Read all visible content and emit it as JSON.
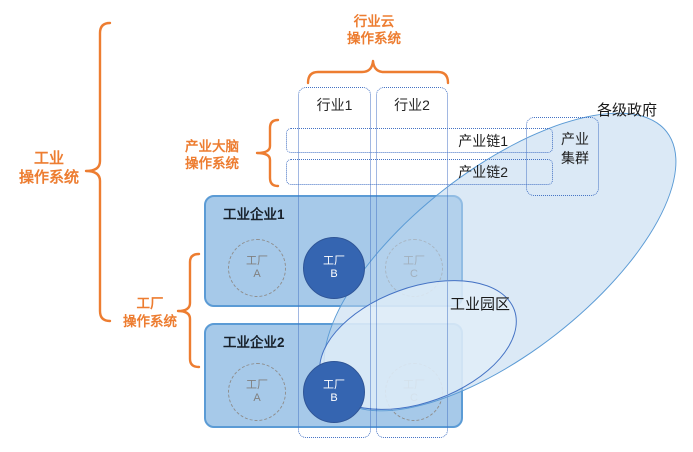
{
  "colors": {
    "accent_orange": "#ED7D31",
    "dashed_blue": "#4472C4",
    "enterprise_fill": "#A6C9E9",
    "enterprise_border": "#5B9BD5",
    "factory_filled_blue": "#3565B1",
    "factory_dashed_gray": "#808080",
    "ellipse_fill_blue": "#BDD7EE"
  },
  "labels": {
    "industry_os": [
      "工业",
      "操作系统"
    ],
    "industry_cloud_os": [
      "行业云",
      "操作系统"
    ],
    "industry_brain_os": [
      "产业大脑",
      "操作系统"
    ],
    "factory_os": [
      "工厂",
      "操作系统"
    ],
    "government": "各级政府",
    "industrial_park": "工业园区",
    "industry_cluster": [
      "产业",
      "集群"
    ]
  },
  "columns": [
    {
      "label": "行业1"
    },
    {
      "label": "行业2"
    }
  ],
  "chains": [
    {
      "label": "产业链1"
    },
    {
      "label": "产业链2"
    }
  ],
  "enterprises": [
    {
      "title": "工业企业1",
      "factories": [
        {
          "name": "工厂",
          "id": "A"
        },
        {
          "name": "工厂",
          "id": "B"
        },
        {
          "name": "工厂",
          "id": "C"
        }
      ]
    },
    {
      "title": "工业企业2",
      "factories": [
        {
          "name": "工厂",
          "id": "A"
        },
        {
          "name": "工厂",
          "id": "B"
        },
        {
          "name": "工厂",
          "id": "C"
        }
      ]
    }
  ]
}
